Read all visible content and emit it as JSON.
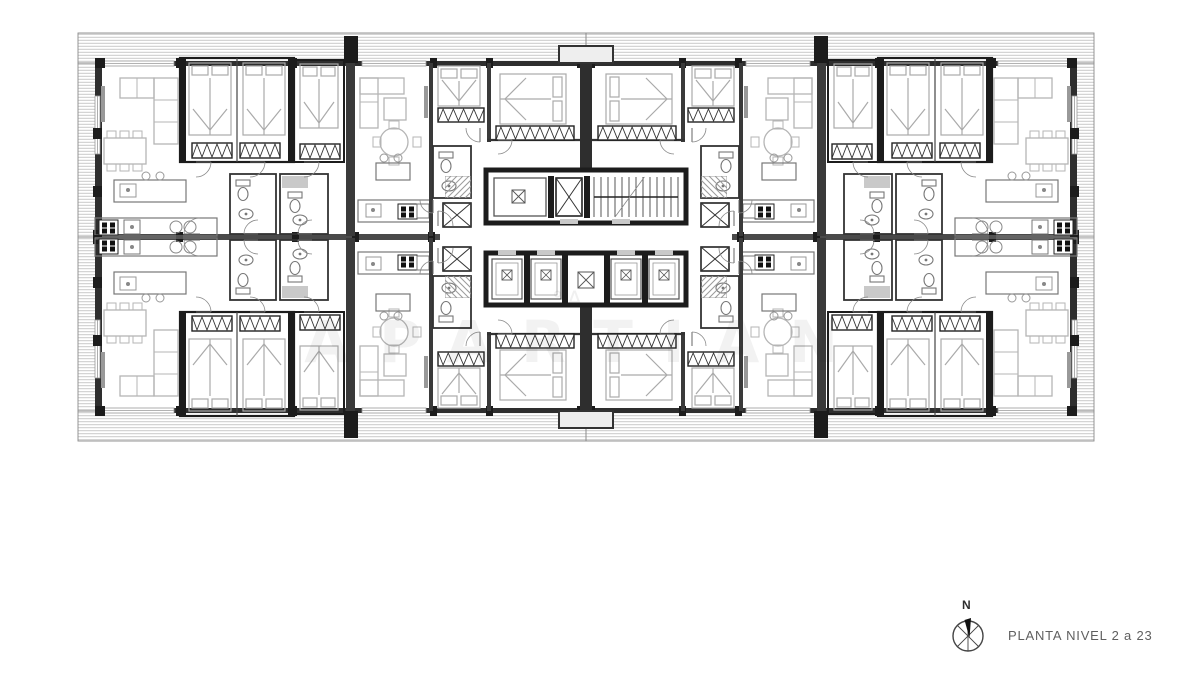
{
  "meta": {
    "type": "architectural-floor-plan"
  },
  "titleblock": {
    "label": "PLANTA NIVEL 2 a 23",
    "north": "N"
  },
  "watermark": {
    "text": "APARTIAN",
    "mark": "°A"
  },
  "drawing": {
    "width": 1200,
    "height": 674,
    "mirror": {
      "tx": 1172,
      "ty": 474
    },
    "palette": {
      "W": "#2e2e2e",
      "K": "#1c1c1c",
      "M": "#555555",
      "F": "#777777",
      "L": "#b5b5b5",
      "H": "#a8a8a8",
      "G": "#c9c9c9"
    },
    "quadrant": [
      {
        "t": "hz",
        "x": 78,
        "y": 33,
        "w": 508,
        "h": 30,
        "g": 3,
        "s": "H",
        "sw": 0.7
      },
      {
        "t": "r",
        "x": 78,
        "y": 33,
        "w": 508,
        "h": 30,
        "s": "#8a8a8a",
        "sw": 0.9
      },
      {
        "t": "hz",
        "x": 78,
        "y": 63,
        "w": 20,
        "h": 174,
        "g": 3,
        "s": "H",
        "sw": 0.7
      },
      {
        "t": "r",
        "x": 78,
        "y": 63,
        "w": 20,
        "h": 174,
        "s": "#8a8a8a",
        "sw": 0.9
      },
      {
        "t": "r",
        "x": 95,
        "y": 61,
        "w": 491,
        "h": 5,
        "f": "W"
      },
      {
        "t": "r",
        "x": 95,
        "y": 61,
        "w": 7,
        "h": 178,
        "f": "W"
      },
      {
        "t": "r",
        "x": 104,
        "y": 61,
        "w": 70,
        "h": 5,
        "f": "#ffffff",
        "s": "#999999",
        "sw": 0.8
      },
      {
        "t": "l",
        "x1": 104,
        "y1": 63.5,
        "x2": 174,
        "y2": 63.5,
        "s": "#999999",
        "sw": 0.8
      },
      {
        "t": "r",
        "x": 362,
        "y": 61,
        "w": 64,
        "h": 5,
        "f": "#ffffff",
        "s": "#999999",
        "sw": 0.8
      },
      {
        "t": "l",
        "x1": 362,
        "y1": 63.5,
        "x2": 426,
        "y2": 63.5,
        "s": "#999999",
        "sw": 0.8
      },
      {
        "t": "r",
        "x": 95,
        "y": 96,
        "w": 5,
        "h": 58,
        "f": "#ffffff",
        "s": "#999999",
        "sw": 0.8
      },
      {
        "t": "l",
        "x1": 97.5,
        "y1": 96,
        "x2": 97.5,
        "y2": 154,
        "s": "#999999",
        "sw": 0.8
      },
      {
        "t": "r",
        "x": 95,
        "y": 58,
        "w": 10,
        "h": 10,
        "f": "K"
      },
      {
        "t": "r",
        "x": 176,
        "y": 58,
        "w": 7,
        "h": 10,
        "f": "K"
      },
      {
        "t": "r",
        "x": 290,
        "y": 58,
        "w": 7,
        "h": 10,
        "f": "K"
      },
      {
        "t": "r",
        "x": 430,
        "y": 58,
        "w": 7,
        "h": 10,
        "f": "K"
      },
      {
        "t": "r",
        "x": 486,
        "y": 58,
        "w": 7,
        "h": 10,
        "f": "K"
      },
      {
        "t": "r",
        "x": 577,
        "y": 58,
        "w": 7,
        "h": 10,
        "f": "K"
      },
      {
        "t": "r",
        "x": 93,
        "y": 128,
        "w": 9,
        "h": 11,
        "f": "K"
      },
      {
        "t": "r",
        "x": 93,
        "y": 186,
        "w": 9,
        "h": 11,
        "f": "K"
      },
      {
        "t": "r",
        "x": 93,
        "y": 230,
        "w": 9,
        "h": 9,
        "f": "K"
      },
      {
        "t": "r",
        "x": 95,
        "y": 234,
        "w": 345,
        "h": 3,
        "f": "#4a4a4a"
      },
      {
        "t": "r",
        "x": 176,
        "y": 232,
        "w": 7,
        "h": 5,
        "f": "K"
      },
      {
        "t": "r",
        "x": 292,
        "y": 232,
        "w": 7,
        "h": 5,
        "f": "K"
      },
      {
        "t": "r",
        "x": 352,
        "y": 232,
        "w": 7,
        "h": 5,
        "f": "K"
      },
      {
        "t": "r",
        "x": 428,
        "y": 232,
        "w": 7,
        "h": 5,
        "f": "K"
      },
      {
        "t": "r",
        "x": 344,
        "y": 36,
        "w": 14,
        "h": 27,
        "f": "K"
      },
      {
        "t": "r",
        "x": 346,
        "y": 63,
        "w": 9,
        "h": 107,
        "f": "#3a3a3a"
      },
      {
        "t": "r",
        "x": 346,
        "y": 170,
        "w": 9,
        "h": 66,
        "f": "#3a3a3a"
      },
      {
        "t": "r",
        "x": 180,
        "y": 58,
        "w": 114,
        "h": 104,
        "s": "K",
        "sw": 2.2
      },
      {
        "t": "r",
        "x": 180,
        "y": 58,
        "w": 6,
        "h": 104,
        "f": "K"
      },
      {
        "t": "r",
        "x": 288,
        "y": 58,
        "w": 6,
        "h": 104,
        "f": "K"
      },
      {
        "t": "l",
        "x1": 237,
        "y1": 58,
        "x2": 237,
        "y2": 162,
        "s": "#444444",
        "sw": 1.2
      },
      {
        "t": "bed",
        "x": 189,
        "y": 63,
        "w": 42,
        "h": 72,
        "d": "n"
      },
      {
        "t": "bed",
        "x": 243,
        "y": 63,
        "w": 42,
        "h": 72,
        "d": "n"
      },
      {
        "t": "zz",
        "x": 192,
        "y": 143,
        "w": 40,
        "h": 15
      },
      {
        "t": "zz",
        "x": 240,
        "y": 143,
        "w": 40,
        "h": 15
      },
      {
        "t": "r",
        "x": 294,
        "y": 60,
        "w": 50,
        "h": 102,
        "s": "K",
        "sw": 2
      },
      {
        "t": "bed",
        "x": 300,
        "y": 64,
        "w": 38,
        "h": 64,
        "d": "n"
      },
      {
        "t": "zz",
        "x": 300,
        "y": 144,
        "w": 40,
        "h": 15
      },
      {
        "t": "r",
        "x": 101,
        "y": 86,
        "w": 4,
        "h": 36,
        "f": "#999999"
      },
      {
        "t": "r",
        "x": 154,
        "y": 78,
        "w": 24,
        "h": 66,
        "s": "L",
        "sw": 1.3
      },
      {
        "t": "r",
        "x": 120,
        "y": 78,
        "w": 34,
        "h": 20,
        "s": "L",
        "sw": 1.3
      },
      {
        "t": "l",
        "x1": 154,
        "y1": 100,
        "x2": 178,
        "y2": 100,
        "s": "L",
        "sw": 1
      },
      {
        "t": "l",
        "x1": 154,
        "y1": 122,
        "x2": 178,
        "y2": 122,
        "s": "L",
        "sw": 1
      },
      {
        "t": "l",
        "x1": 137,
        "y1": 78,
        "x2": 137,
        "y2": 98,
        "s": "L",
        "sw": 1
      },
      {
        "t": "r",
        "x": 104,
        "y": 138,
        "w": 42,
        "h": 26,
        "s": "L",
        "sw": 1.3
      },
      {
        "t": "r",
        "x": 107,
        "y": 131,
        "w": 9,
        "h": 7,
        "s": "L",
        "sw": 1
      },
      {
        "t": "r",
        "x": 120,
        "y": 131,
        "w": 9,
        "h": 7,
        "s": "L",
        "sw": 1
      },
      {
        "t": "r",
        "x": 133,
        "y": 131,
        "w": 9,
        "h": 7,
        "s": "L",
        "sw": 1
      },
      {
        "t": "r",
        "x": 107,
        "y": 164,
        "w": 9,
        "h": 7,
        "s": "L",
        "sw": 1
      },
      {
        "t": "r",
        "x": 120,
        "y": 164,
        "w": 9,
        "h": 7,
        "s": "L",
        "sw": 1
      },
      {
        "t": "r",
        "x": 133,
        "y": 164,
        "w": 9,
        "h": 7,
        "s": "L",
        "sw": 1
      },
      {
        "t": "r",
        "x": 114,
        "y": 180,
        "w": 72,
        "h": 22,
        "s": "F",
        "sw": 1.2
      },
      {
        "t": "r",
        "x": 120,
        "y": 184,
        "w": 16,
        "h": 13,
        "s": "#999999",
        "sw": 1
      },
      {
        "t": "c",
        "cx": 128,
        "cy": 190,
        "r": 2,
        "f": "#888888"
      },
      {
        "t": "c",
        "cx": 146,
        "cy": 176,
        "r": 4,
        "s": "#999999",
        "sw": 1
      },
      {
        "t": "c",
        "cx": 160,
        "cy": 176,
        "r": 4,
        "s": "#999999",
        "sw": 1
      },
      {
        "t": "r",
        "x": 95,
        "y": 218,
        "w": 122,
        "h": 18,
        "s": "F",
        "sw": 1.2
      },
      {
        "t": "stb",
        "x": 99,
        "y": 220
      },
      {
        "t": "r",
        "x": 124,
        "y": 220,
        "w": 16,
        "h": 14,
        "s": "F",
        "sw": 1
      },
      {
        "t": "c",
        "cx": 132,
        "cy": 227,
        "r": 2,
        "f": "#888888"
      },
      {
        "t": "c",
        "cx": 176,
        "cy": 227,
        "r": 6,
        "s": "#888888",
        "sw": 1
      },
      {
        "t": "c",
        "cx": 190,
        "cy": 227,
        "r": 6,
        "s": "#888888",
        "sw": 1
      },
      {
        "t": "r",
        "x": 230,
        "y": 174,
        "w": 46,
        "h": 60,
        "s": "#333333",
        "sw": 1.8
      },
      {
        "t": "wc",
        "x": 236,
        "y": 180
      },
      {
        "t": "sk",
        "x": 246,
        "y": 214
      },
      {
        "t": "r",
        "x": 280,
        "y": 174,
        "w": 48,
        "h": 60,
        "s": "#333333",
        "sw": 1.8
      },
      {
        "t": "r",
        "x": 282,
        "y": 176,
        "w": 26,
        "h": 12,
        "f": "G"
      },
      {
        "t": "wc",
        "x": 288,
        "y": 192
      },
      {
        "t": "sk",
        "x": 300,
        "y": 220
      },
      {
        "t": "r",
        "x": 360,
        "y": 78,
        "w": 18,
        "h": 50,
        "s": "L",
        "sw": 1.3
      },
      {
        "t": "r",
        "x": 360,
        "y": 78,
        "w": 44,
        "h": 16,
        "s": "L",
        "sw": 1.3
      },
      {
        "t": "l",
        "x1": 360,
        "y1": 102,
        "x2": 378,
        "y2": 102,
        "s": "L",
        "sw": 1
      },
      {
        "t": "r",
        "x": 384,
        "y": 98,
        "w": 22,
        "h": 22,
        "s": "L",
        "sw": 1.3
      },
      {
        "t": "c",
        "cx": 394,
        "cy": 142,
        "r": 14,
        "s": "L",
        "sw": 1.3
      },
      {
        "t": "r",
        "x": 389,
        "y": 121,
        "w": 10,
        "h": 8,
        "s": "L",
        "sw": 1
      },
      {
        "t": "r",
        "x": 389,
        "y": 157,
        "w": 10,
        "h": 8,
        "s": "L",
        "sw": 1
      },
      {
        "t": "r",
        "x": 373,
        "y": 137,
        "w": 8,
        "h": 10,
        "s": "L",
        "sw": 1
      },
      {
        "t": "r",
        "x": 413,
        "y": 137,
        "w": 8,
        "h": 10,
        "s": "L",
        "sw": 1
      },
      {
        "t": "r",
        "x": 424,
        "y": 86,
        "w": 4,
        "h": 32,
        "f": "#999999"
      },
      {
        "t": "r",
        "x": 376,
        "y": 163,
        "w": 34,
        "h": 17,
        "s": "F",
        "sw": 1.2
      },
      {
        "t": "c",
        "cx": 384,
        "cy": 158,
        "r": 4,
        "s": "#999999",
        "sw": 1
      },
      {
        "t": "c",
        "cx": 398,
        "cy": 158,
        "r": 4,
        "s": "#999999",
        "sw": 1
      },
      {
        "t": "r",
        "x": 358,
        "y": 200,
        "w": 72,
        "h": 22,
        "s": "F",
        "sw": 1.2
      },
      {
        "t": "r",
        "x": 366,
        "y": 204,
        "w": 15,
        "h": 13,
        "s": "#999999",
        "sw": 1
      },
      {
        "t": "c",
        "cx": 373,
        "cy": 210,
        "r": 2,
        "f": "#888888"
      },
      {
        "t": "stb",
        "x": 398,
        "y": 204
      },
      {
        "t": "r",
        "x": 417,
        "y": 204,
        "w": 12,
        "h": 14,
        "s": "F",
        "sw": 1
      },
      {
        "t": "r",
        "x": 429,
        "y": 63,
        "w": 4,
        "h": 173,
        "f": "#3a3a3a"
      },
      {
        "t": "r",
        "x": 487,
        "y": 63,
        "w": 4,
        "h": 79,
        "f": "#3a3a3a"
      },
      {
        "t": "l",
        "x1": 487,
        "y1": 140,
        "x2": 580,
        "y2": 140,
        "s": "#333333",
        "sw": 2.2
      },
      {
        "t": "r",
        "x": 580,
        "y": 63,
        "w": 6,
        "h": 107,
        "f": "W"
      },
      {
        "t": "bed",
        "x": 438,
        "y": 66,
        "w": 42,
        "h": 40,
        "d": "n"
      },
      {
        "t": "zz",
        "x": 438,
        "y": 108,
        "w": 46,
        "h": 14
      },
      {
        "t": "bed",
        "x": 500,
        "y": 74,
        "w": 66,
        "h": 50,
        "d": "e"
      },
      {
        "t": "zz",
        "x": 496,
        "y": 126,
        "w": 78,
        "h": 14
      },
      {
        "t": "r",
        "x": 433,
        "y": 146,
        "w": 38,
        "h": 52,
        "s": "#333333",
        "sw": 1.8
      },
      {
        "t": "wc",
        "x": 439,
        "y": 152
      },
      {
        "t": "sk",
        "x": 449,
        "y": 186
      },
      {
        "t": "xb",
        "x": 443,
        "y": 203,
        "w": 28,
        "h": 24
      },
      {
        "t": "hd",
        "x": 445,
        "y": 176,
        "w": 26,
        "h": 22,
        "g": 6
      },
      {
        "t": "a",
        "x": 196,
        "y": 162,
        "r": 15,
        "a0": 0,
        "a1": 90
      },
      {
        "t": "a",
        "x": 250,
        "y": 162,
        "r": 15,
        "a0": 0,
        "a1": 90
      },
      {
        "t": "a",
        "x": 304,
        "y": 162,
        "r": 15,
        "a0": 0,
        "a1": 90
      },
      {
        "t": "a",
        "x": 480,
        "y": 128,
        "r": 14,
        "a0": 90,
        "a1": 180
      },
      {
        "t": "a",
        "x": 498,
        "y": 140,
        "r": 14,
        "a0": 0,
        "a1": 90
      },
      {
        "t": "a",
        "x": 258,
        "y": 234,
        "r": 14,
        "a0": 180,
        "a1": 270
      },
      {
        "t": "a",
        "x": 312,
        "y": 234,
        "r": 14,
        "a0": 180,
        "a1": 270
      },
      {
        "t": "a",
        "x": 200,
        "y": 234,
        "r": 16,
        "a0": 180,
        "a1": 270
      },
      {
        "t": "a",
        "x": 433,
        "y": 200,
        "r": 13,
        "a0": 90,
        "a1": 180
      },
      {
        "t": "a",
        "x": 438,
        "y": 226,
        "r": 15,
        "a0": 270,
        "a1": 360
      }
    ],
    "core": [
      {
        "t": "r",
        "x": 486,
        "y": 170,
        "w": 200,
        "h": 53,
        "s": "K",
        "sw": 5,
        "f": "#ffffff"
      },
      {
        "t": "r",
        "x": 494,
        "y": 178,
        "w": 52,
        "h": 38,
        "s": "M",
        "sw": 1.3
      },
      {
        "t": "xs",
        "x": 512,
        "y": 190,
        "w": 13
      },
      {
        "t": "r",
        "x": 548,
        "y": 176,
        "w": 6,
        "h": 42,
        "f": "K"
      },
      {
        "t": "xb",
        "x": 556,
        "y": 178,
        "w": 26,
        "h": 38
      },
      {
        "t": "r",
        "x": 584,
        "y": 176,
        "w": 6,
        "h": 42,
        "f": "K"
      },
      {
        "t": "stair",
        "x": 594,
        "y": 177,
        "w": 84,
        "h": 40,
        "n": 12
      },
      {
        "t": "r",
        "x": 560,
        "y": 219,
        "w": 18,
        "h": 5,
        "f": "G"
      },
      {
        "t": "r",
        "x": 612,
        "y": 219,
        "w": 18,
        "h": 5,
        "f": "G"
      },
      {
        "t": "r",
        "x": 486,
        "y": 253,
        "w": 200,
        "h": 52,
        "s": "K",
        "sw": 5,
        "f": "#ffffff"
      },
      {
        "t": "r",
        "x": 524,
        "y": 255,
        "w": 6,
        "h": 48,
        "f": "K"
      },
      {
        "t": "r",
        "x": 562,
        "y": 255,
        "w": 6,
        "h": 48,
        "f": "K"
      },
      {
        "t": "r",
        "x": 604,
        "y": 255,
        "w": 6,
        "h": 48,
        "f": "K"
      },
      {
        "t": "r",
        "x": 642,
        "y": 255,
        "w": 6,
        "h": 48,
        "f": "K"
      },
      {
        "t": "cab",
        "x": 492,
        "y": 259
      },
      {
        "t": "cab",
        "x": 531,
        "y": 259
      },
      {
        "t": "xs",
        "x": 578,
        "y": 272,
        "w": 16
      },
      {
        "t": "cab",
        "x": 611,
        "y": 259
      },
      {
        "t": "cab",
        "x": 649,
        "y": 259
      },
      {
        "t": "r",
        "x": 498,
        "y": 250,
        "w": 18,
        "h": 5,
        "f": "G"
      },
      {
        "t": "r",
        "x": 537,
        "y": 250,
        "w": 18,
        "h": 5,
        "f": "G"
      },
      {
        "t": "r",
        "x": 617,
        "y": 250,
        "w": 18,
        "h": 5,
        "f": "G"
      },
      {
        "t": "r",
        "x": 655,
        "y": 250,
        "w": 18,
        "h": 5,
        "f": "G"
      },
      {
        "t": "r",
        "x": 559,
        "y": 46,
        "w": 54,
        "h": 17,
        "f": "#eeeeee",
        "s": "#333333",
        "sw": 2
      },
      {
        "t": "r",
        "x": 559,
        "y": 411,
        "w": 54,
        "h": 17,
        "f": "#eeeeee",
        "s": "#333333",
        "sw": 2
      }
    ]
  }
}
